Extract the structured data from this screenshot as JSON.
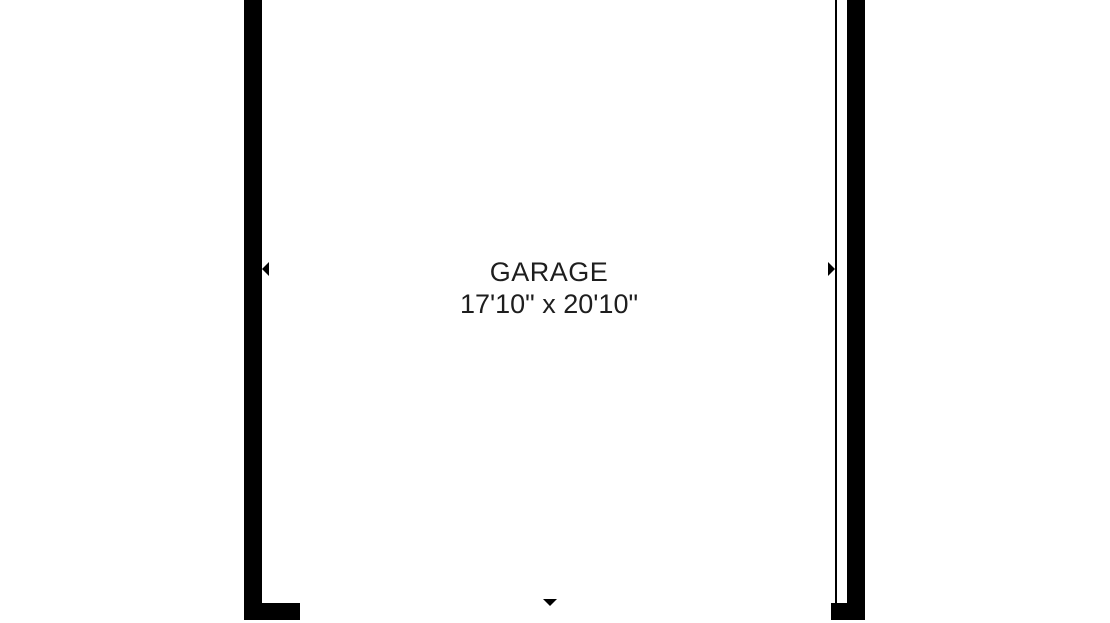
{
  "floor_plan": {
    "room": {
      "name": "GARAGE",
      "dimensions": "17'10\" x 20'10\""
    },
    "markers": {
      "left_wall_marker": "left-pointing-triangle",
      "right_wall_marker": "right-pointing-triangle",
      "bottom_center_marker": "down-pointing-triangle"
    },
    "colors": {
      "wall": "#000000",
      "background": "#ffffff",
      "text": "#1e1e1e"
    }
  }
}
